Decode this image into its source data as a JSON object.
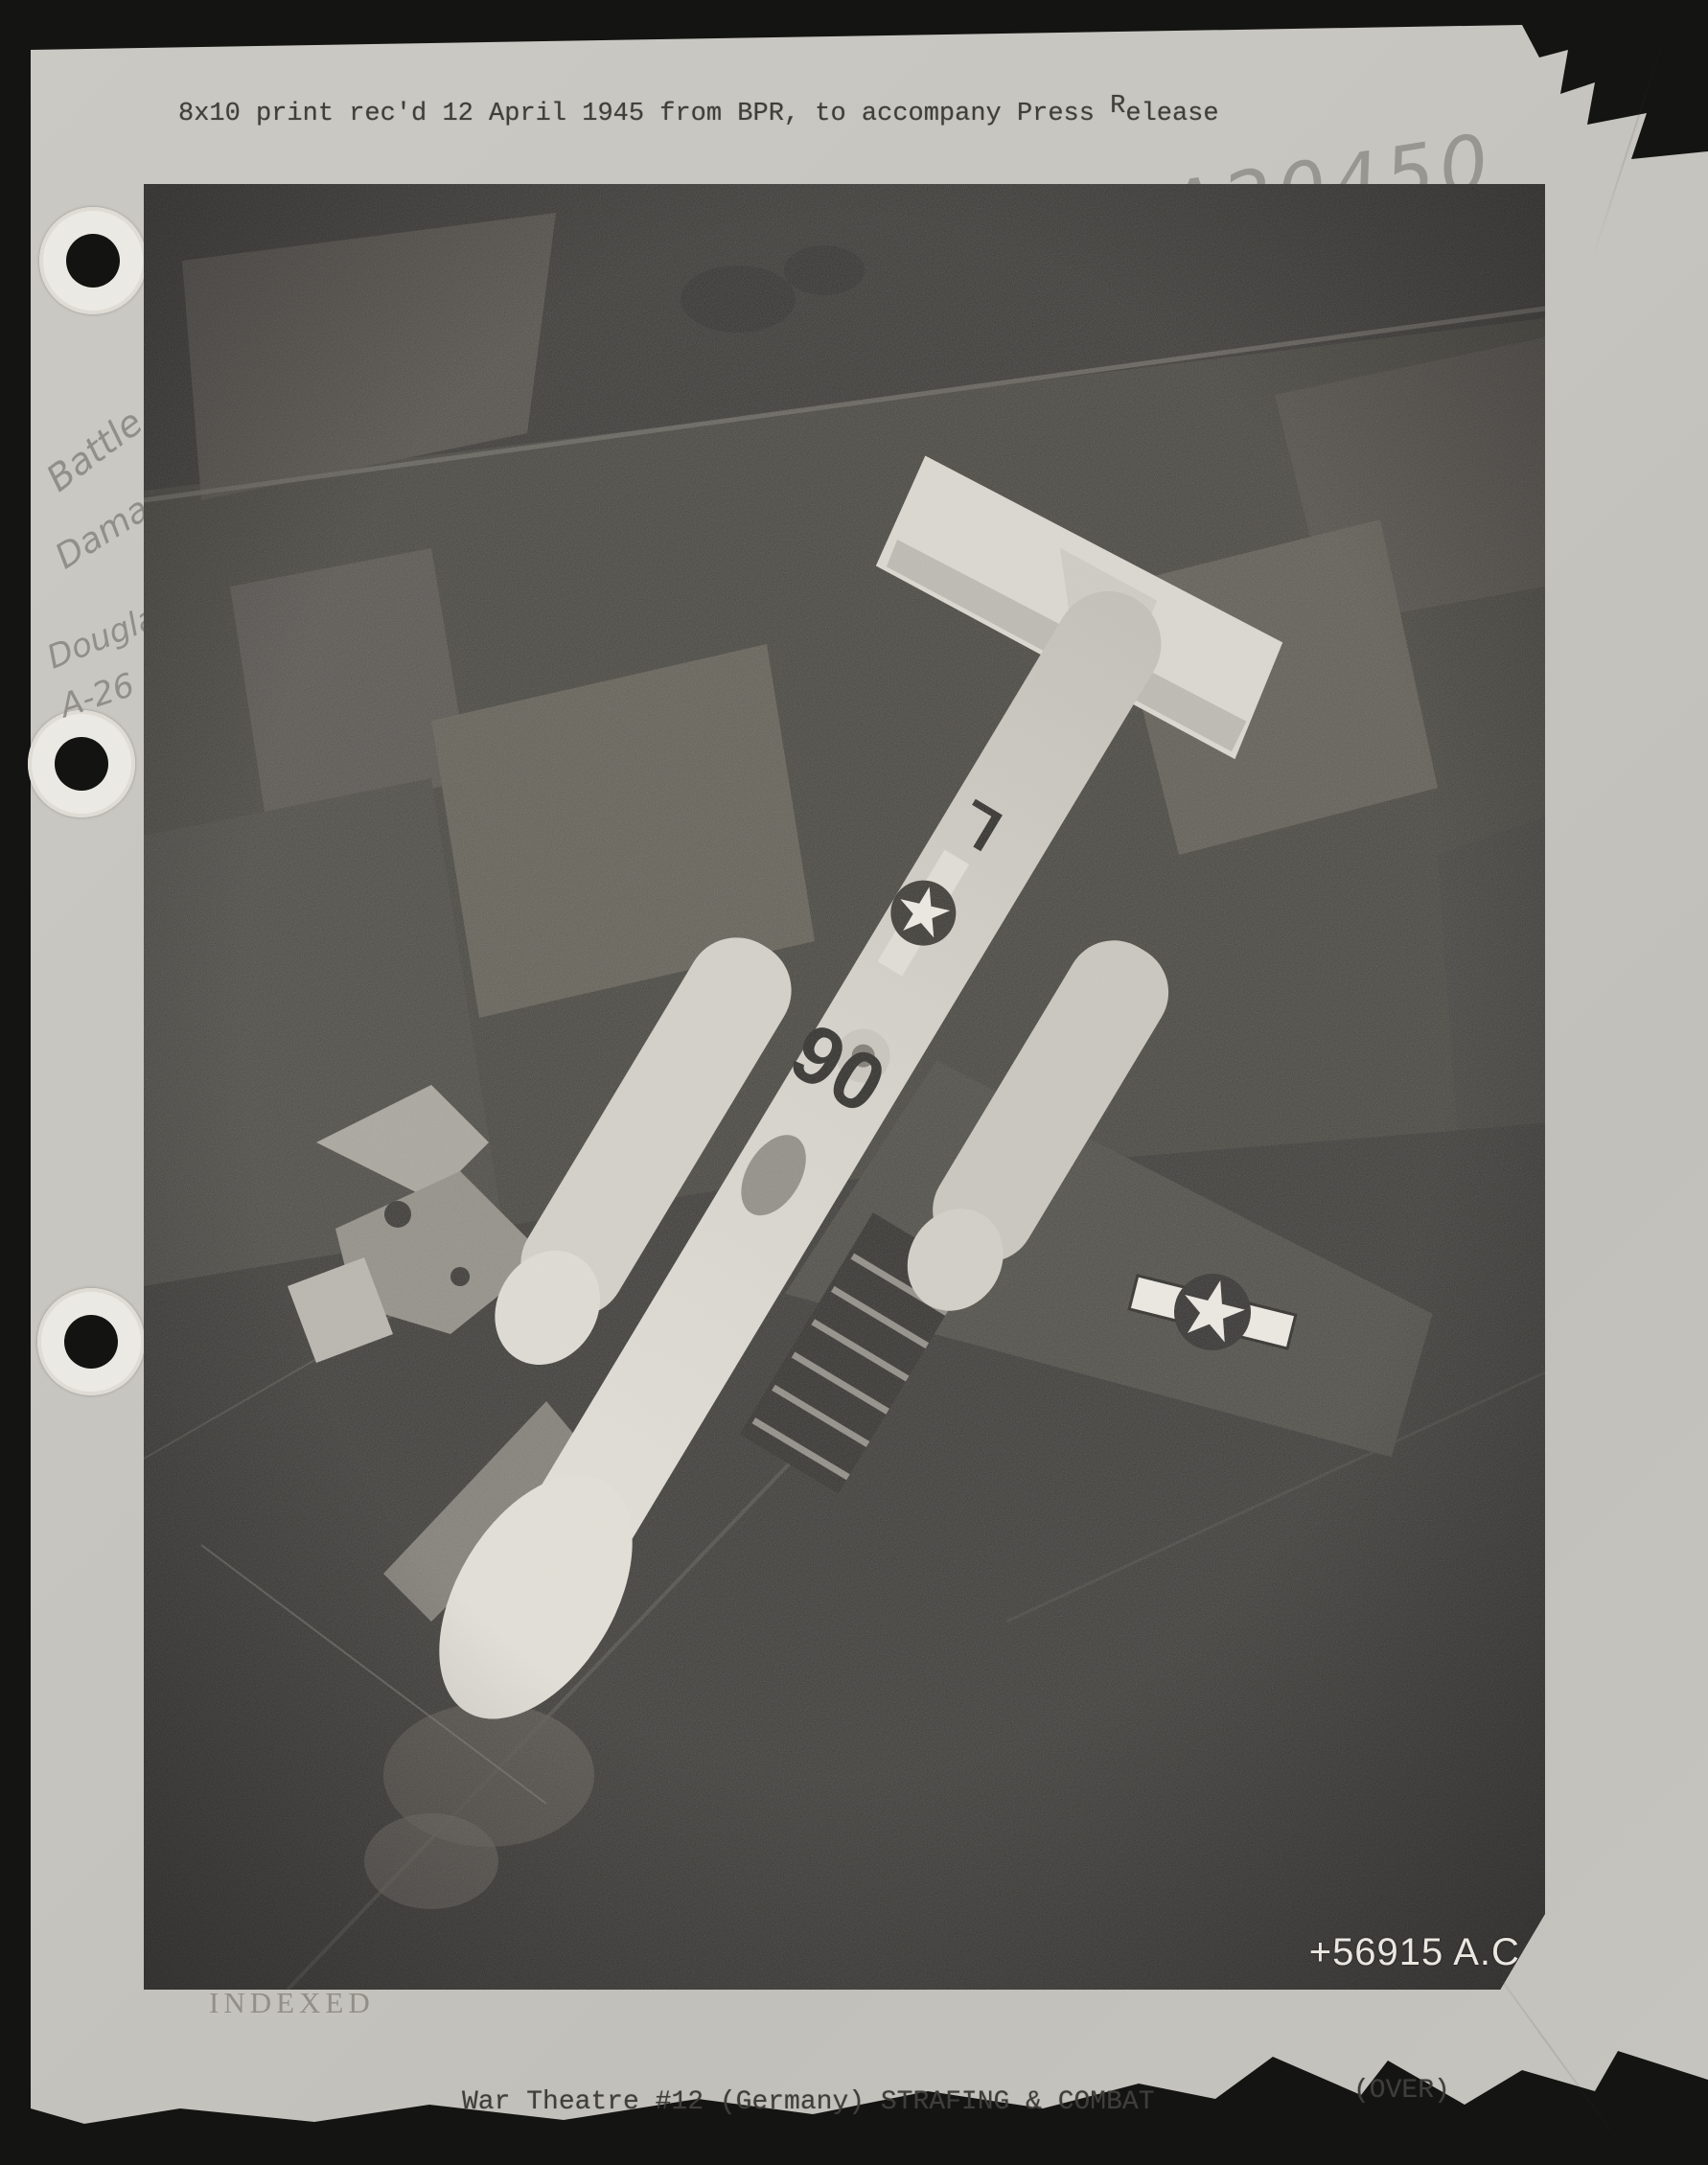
{
  "scan": {
    "background_color": "#141412",
    "paper_color": "#c8c6c0"
  },
  "header": {
    "line1_pre": "8x10 print rec'd 12 April 1945 from BPR, to accompany Press ",
    "line1_sup": "R",
    "line1_post": "elease",
    "line2": "\"INVADER'S END\"  Copied 12 April 1945."
  },
  "pencil": {
    "catalog": "A20450",
    "note1": "Battle",
    "note2": "Damage",
    "note3": "Douglas",
    "note4": "A-26"
  },
  "photo": {
    "stamp": "+56915 A.C.",
    "code_front": "06",
    "code_letter": "L",
    "insignia": "us-star-and-bar",
    "description": "Douglas A-26 Invader seen from directly above, banking over German farmland with bomb bay open and damaged left wing"
  },
  "stamps": {
    "indexed": "INDEXED"
  },
  "footer": {
    "caption": "War Theatre #12 (Germany) STRAFING & COMBAT",
    "over": "(OVER)"
  }
}
